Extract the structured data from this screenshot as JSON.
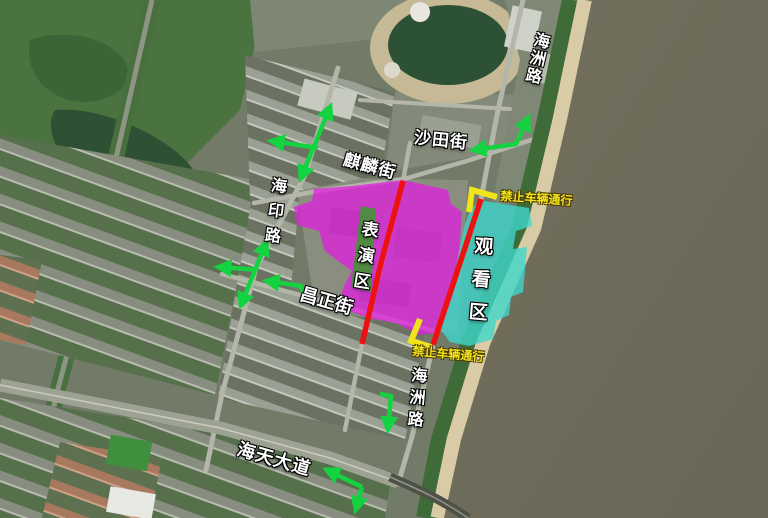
{
  "labels": {
    "haizhou_north": {
      "text": "海洲路"
    },
    "shatian": {
      "text": "沙田街"
    },
    "qilin": {
      "text": "麒麟街"
    },
    "haiyin": {
      "text": "海印路"
    },
    "performance_zone": {
      "text": "表演区"
    },
    "viewing_zone": {
      "text": "观看区"
    },
    "changzheng": {
      "text": "昌正街"
    },
    "haizhou_south": {
      "text": "海洲路"
    },
    "haitian": {
      "text": "海天大道"
    },
    "closure_north": {
      "text": "禁止车辆通行"
    },
    "closure_south": {
      "text": "禁止车辆通行"
    }
  },
  "overlay": {
    "colors": {
      "arrow": "#14d341",
      "closed_road": "#ee1111",
      "closure": "#f2e41a",
      "performance_zone_fill": "rgba(228,26,227,0.72)",
      "viewing_zone_fill": "rgba(62,214,203,0.8)",
      "median_green": "rgba(74,143,60,0.95)"
    },
    "zones": [
      {
        "name": "performance-zone-area",
        "fill_key": "performance_zone_fill",
        "points": [
          [
            314,
            189
          ],
          [
            352,
            186
          ],
          [
            403,
            180
          ],
          [
            448,
            190
          ],
          [
            451,
            204
          ],
          [
            462,
            212
          ],
          [
            459,
            252
          ],
          [
            454,
            296
          ],
          [
            447,
            316
          ],
          [
            439,
            333
          ],
          [
            419,
            335
          ],
          [
            396,
            323
          ],
          [
            368,
            318
          ],
          [
            352,
            312
          ],
          [
            339,
            300
          ],
          [
            345,
            284
          ],
          [
            352,
            271
          ],
          [
            338,
            261
          ],
          [
            325,
            251
          ],
          [
            319,
            231
          ],
          [
            297,
            225
          ],
          [
            294,
            207
          ],
          [
            312,
            201
          ]
        ]
      },
      {
        "name": "median-green-strip",
        "fill_key": "median_green",
        "points": [
          [
            361,
            206
          ],
          [
            376,
            209
          ],
          [
            371,
            292
          ],
          [
            351,
            287
          ]
        ]
      },
      {
        "name": "viewing-zone-area",
        "fill_key": "viewing_zone_fill",
        "points": [
          [
            484,
            201
          ],
          [
            529,
            208
          ],
          [
            532,
            226
          ],
          [
            516,
            231
          ],
          [
            513,
            249
          ],
          [
            527,
            247
          ],
          [
            523,
            292
          ],
          [
            511,
            297
          ],
          [
            509,
            315
          ],
          [
            496,
            321
          ],
          [
            493,
            339
          ],
          [
            469,
            346
          ],
          [
            450,
            342
          ],
          [
            441,
            330
          ],
          [
            449,
            299
          ],
          [
            457,
            262
          ],
          [
            464,
            228
          ],
          [
            471,
            207
          ]
        ]
      }
    ],
    "closed_road_lines": [
      {
        "name": "closed-road-inner-street",
        "points": [
          [
            403,
            181
          ],
          [
            381,
            263
          ],
          [
            362,
            344
          ]
        ]
      },
      {
        "name": "closed-road-haizhou",
        "points": [
          [
            481,
            199
          ],
          [
            457,
            272
          ],
          [
            433,
            345
          ]
        ]
      }
    ],
    "closure_brackets": [
      {
        "name": "closure-bracket-north",
        "points": [
          [
            469,
            212
          ],
          [
            472,
            190
          ],
          [
            497,
            197
          ]
        ]
      },
      {
        "name": "closure-bracket-south",
        "points": [
          [
            420,
            319
          ],
          [
            411,
            341
          ],
          [
            431,
            347
          ]
        ]
      }
    ],
    "arrows": [
      {
        "name": "arrow-haiyin-north-twoway",
        "heads": "both",
        "points": [
          [
            301,
            178
          ],
          [
            330,
            107
          ]
        ]
      },
      {
        "name": "arrow-qilin-west",
        "heads": "end",
        "points": [
          [
            318,
            148
          ],
          [
            272,
            141
          ]
        ]
      },
      {
        "name": "arrow-shatian-elbow",
        "heads": "both",
        "points": [
          [
            528,
            118
          ],
          [
            516,
            144
          ],
          [
            474,
            150
          ]
        ]
      },
      {
        "name": "arrow-haiyin-south-twoway",
        "heads": "both",
        "points": [
          [
            266,
            243
          ],
          [
            241,
            305
          ]
        ]
      },
      {
        "name": "arrow-changzheng-west",
        "heads": "end",
        "points": [
          [
            258,
            270
          ],
          [
            219,
            267
          ]
        ]
      },
      {
        "name": "arrow-changzheng-label",
        "heads": "end",
        "points": [
          [
            305,
            297
          ],
          [
            301,
            286
          ],
          [
            267,
            281
          ]
        ]
      },
      {
        "name": "arrow-haizhou-south-elbow",
        "heads": "end",
        "points": [
          [
            380,
            394
          ],
          [
            391,
            396
          ],
          [
            388,
            429
          ]
        ]
      },
      {
        "name": "arrow-haitian-west",
        "heads": "end",
        "points": [
          [
            362,
            487
          ],
          [
            327,
            470
          ]
        ]
      },
      {
        "name": "arrow-haitian-south",
        "heads": "end",
        "points": [
          [
            362,
            487
          ],
          [
            356,
            509
          ]
        ]
      }
    ]
  }
}
